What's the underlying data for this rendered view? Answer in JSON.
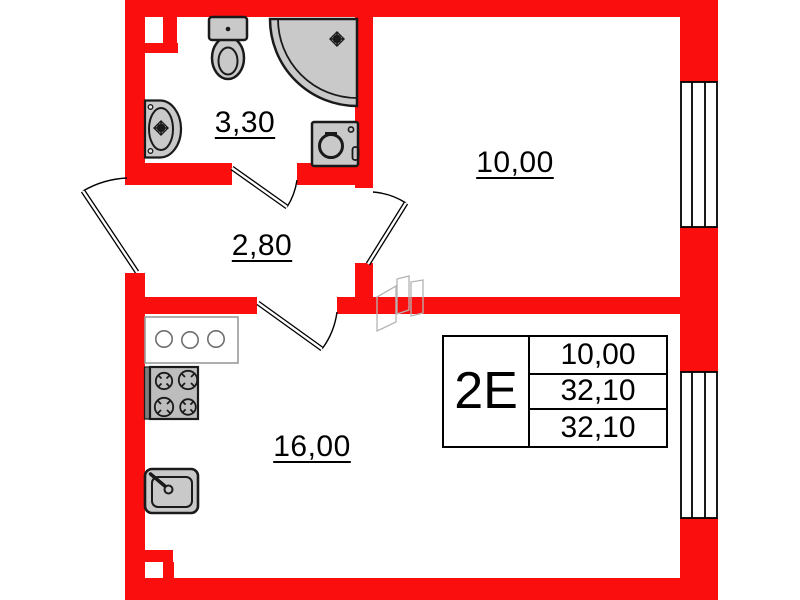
{
  "plan": {
    "title": "apartment-floor-plan",
    "unit_code": "2Е",
    "labels": {
      "bathroom_area": "3,30",
      "hallway_area": "2,80",
      "room_area": "10,00",
      "kitchen_area": "16,00"
    },
    "info_table": {
      "unit_type": "2Е",
      "rows": [
        "10,00",
        "32,10",
        "32,10"
      ]
    },
    "colors": {
      "wall_red": "#fb0e0e",
      "fixture_gray": "#c9c9c9",
      "outline_black": "#1a1a1a",
      "counter_outline_gray": "#9a9a9a",
      "sketch_gray": "#b4b4b4"
    },
    "icons": [
      "toilet-icon",
      "shower-icon",
      "washing-machine-icon",
      "bathroom-sink-icon",
      "kitchen-counter-icon",
      "stove-icon",
      "kitchen-sink-icon",
      "window-icon",
      "door-swing-icon",
      "vent-shaft-sketch"
    ]
  }
}
